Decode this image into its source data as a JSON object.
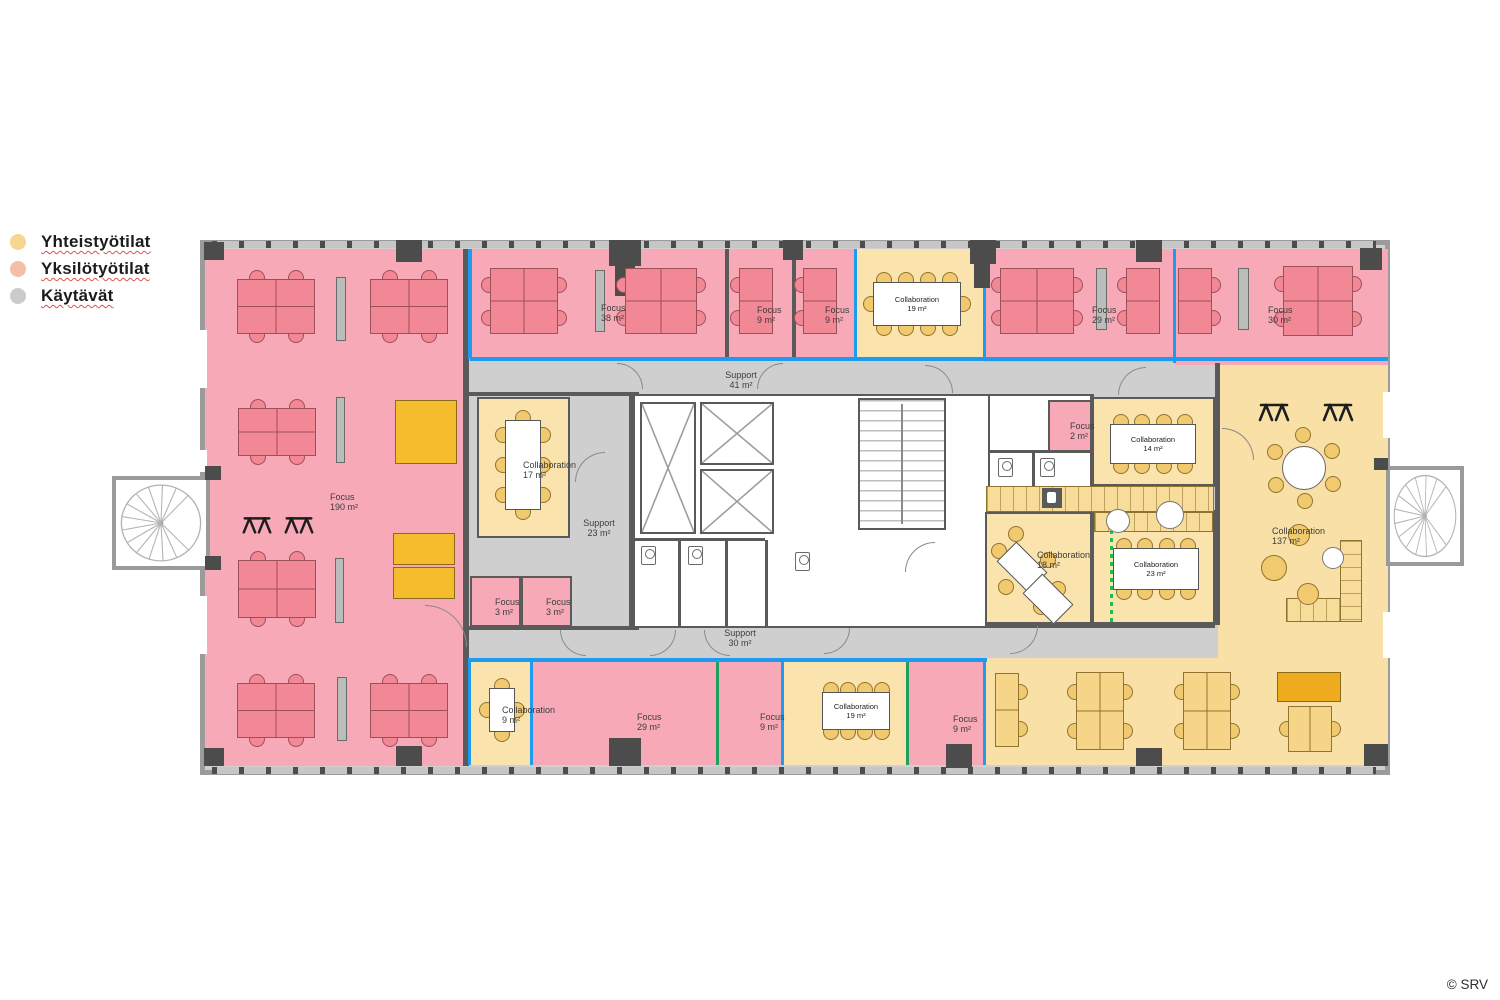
{
  "legend": {
    "items": [
      {
        "id": "yhteistyotilat",
        "label": "Yhteistyötilat",
        "color": "#f6d78f"
      },
      {
        "id": "yksilotyotilat",
        "label": "Yksilötyötilat",
        "color": "#f2bfa9"
      },
      {
        "id": "kaytavat",
        "label": "Käytävät",
        "color": "#cbcbcb"
      }
    ]
  },
  "copyright": "© SRV",
  "palette": {
    "individual_room": "#f7a9b8",
    "collab_room": "#fae3ad",
    "open_collab": "#f9e0a6",
    "corridor": "#cfcfcf",
    "wall": "#5a5a5a",
    "glass_blue": "#1e9bf0",
    "glass_green": "#1fa05c",
    "movable_partition": "#19c24e",
    "desk_pink": "#f28795",
    "desk_yellow": "#f6d488",
    "chair_yellow": "#f1c96f",
    "cabinet_yellow": "#f5bc2e"
  },
  "floorplan": {
    "canvas": {
      "x": 200,
      "y": 240,
      "w": 1190,
      "h": 535
    },
    "rooms": [
      {
        "id": "focus-190",
        "type": "pink",
        "x": 205,
        "y": 249,
        "w": 260,
        "h": 517,
        "label": {
          "name": "Focus",
          "area": "190 m²",
          "x": 330,
          "y": 492
        }
      },
      {
        "id": "focus-38",
        "type": "pink",
        "x": 468,
        "y": 249,
        "w": 259,
        "h": 112,
        "label": {
          "name": "Focus",
          "area": "38 m²",
          "x": 601,
          "y": 303
        }
      },
      {
        "id": "focus-9-a",
        "type": "pink",
        "x": 727,
        "y": 249,
        "w": 67,
        "h": 112,
        "label": {
          "name": "Focus",
          "area": "9 m²",
          "x": 757,
          "y": 305
        }
      },
      {
        "id": "focus-9-b",
        "type": "pink",
        "x": 794,
        "y": 249,
        "w": 62,
        "h": 112,
        "label": {
          "name": "Focus",
          "area": "9 m²",
          "x": 825,
          "y": 305
        }
      },
      {
        "id": "collab-19-top",
        "type": "yellow",
        "x": 856,
        "y": 249,
        "w": 129,
        "h": 112
      },
      {
        "id": "focus-29-top",
        "type": "pink",
        "x": 985,
        "y": 249,
        "w": 190,
        "h": 113,
        "label": {
          "name": "Focus",
          "area": "29 m²",
          "x": 1092,
          "y": 305
        }
      },
      {
        "id": "focus-30",
        "type": "pink",
        "x": 1175,
        "y": 249,
        "w": 213,
        "h": 116,
        "label": {
          "name": "Focus",
          "area": "30 m²",
          "x": 1268,
          "y": 305
        }
      },
      {
        "id": "collab-17",
        "type": "yellow",
        "border": true,
        "x": 477,
        "y": 397,
        "w": 93,
        "h": 141,
        "label": {
          "name": "Collaboration",
          "area": "17 m²",
          "x": 523,
          "y": 460
        }
      },
      {
        "id": "focus-3-a",
        "type": "pink",
        "border": true,
        "x": 470,
        "y": 576,
        "w": 51,
        "h": 51,
        "label": {
          "name": "Focus",
          "area": "3 m²",
          "x": 495,
          "y": 597
        }
      },
      {
        "id": "focus-3-b",
        "type": "pink",
        "border": true,
        "x": 521,
        "y": 576,
        "w": 51,
        "h": 51,
        "label": {
          "name": "Focus",
          "area": "3 m²",
          "x": 546,
          "y": 597
        }
      },
      {
        "id": "core",
        "type": "white",
        "border": true,
        "x": 633,
        "y": 394,
        "w": 357,
        "h": 234
      },
      {
        "id": "wc-right",
        "type": "white",
        "border": true,
        "x": 988,
        "y": 394,
        "w": 104,
        "h": 118
      },
      {
        "id": "focus-2",
        "type": "pink",
        "border": true,
        "x": 1048,
        "y": 400,
        "w": 44,
        "h": 52,
        "label": {
          "name": "Focus",
          "area": "2 m²",
          "x": 1070,
          "y": 421
        }
      },
      {
        "id": "collab-18",
        "type": "yellow",
        "border": true,
        "x": 985,
        "y": 512,
        "w": 107,
        "h": 112,
        "label": {
          "name": "Collaboration",
          "area": "18 m²",
          "x": 1037,
          "y": 550
        }
      },
      {
        "id": "collab-14",
        "type": "yellow",
        "border": true,
        "x": 1092,
        "y": 397,
        "w": 123,
        "h": 89
      },
      {
        "id": "collab-23",
        "type": "yellow",
        "border": true,
        "x": 1092,
        "y": 510,
        "w": 123,
        "h": 114
      },
      {
        "id": "collab-137",
        "type": "open",
        "x": 1218,
        "y": 365,
        "w": 170,
        "h": 400,
        "label": {
          "name": "Collaboration",
          "area": "137 m²",
          "x": 1272,
          "y": 526
        }
      },
      {
        "id": "open-desk-area",
        "type": "open",
        "x": 985,
        "y": 658,
        "w": 403,
        "h": 107
      },
      {
        "id": "collab-9",
        "type": "yellow",
        "x": 470,
        "y": 660,
        "w": 62,
        "h": 105,
        "label": {
          "name": "Collaboration",
          "area": "9 m²",
          "x": 502,
          "y": 705
        }
      },
      {
        "id": "focus-29-bottom",
        "type": "pink",
        "x": 532,
        "y": 660,
        "w": 186,
        "h": 105,
        "label": {
          "name": "Focus",
          "area": "29 m²",
          "x": 637,
          "y": 712
        }
      },
      {
        "id": "focus-9-c",
        "type": "pink",
        "x": 718,
        "y": 660,
        "w": 65,
        "h": 105,
        "label": {
          "name": "Focus",
          "area": "9 m²",
          "x": 760,
          "y": 712
        }
      },
      {
        "id": "collab-19-bottom",
        "type": "yellow",
        "x": 783,
        "y": 660,
        "w": 125,
        "h": 105
      },
      {
        "id": "focus-9-d",
        "type": "pink",
        "x": 908,
        "y": 660,
        "w": 77,
        "h": 105,
        "label": {
          "name": "Focus",
          "area": "9 m²",
          "x": 953,
          "y": 714
        }
      }
    ],
    "support_labels": [
      {
        "name": "Support",
        "area": "41 m²",
        "x": 741,
        "y": 380
      },
      {
        "name": "Support",
        "area": "23 m²",
        "x": 599,
        "y": 528
      },
      {
        "name": "Support",
        "area": "30 m²",
        "x": 740,
        "y": 638
      }
    ],
    "walls": [
      [
        463,
        249,
        6,
        517
      ],
      [
        725,
        249,
        4,
        112
      ],
      [
        792,
        249,
        4,
        112
      ],
      [
        467,
        392,
        172,
        4
      ],
      [
        467,
        626,
        172,
        4
      ],
      [
        629,
        392,
        4,
        238
      ],
      [
        1090,
        394,
        4,
        230
      ],
      [
        1215,
        363,
        5,
        262
      ],
      [
        1092,
        484,
        123,
        3
      ],
      [
        635,
        538,
        130,
        3
      ],
      [
        678,
        541,
        3,
        85
      ],
      [
        725,
        541,
        3,
        85
      ],
      [
        765,
        540,
        3,
        86
      ],
      [
        990,
        450,
        100,
        3
      ],
      [
        1032,
        452,
        3,
        56
      ],
      [
        985,
        624,
        230,
        4
      ]
    ],
    "partitions": {
      "blue": [
        [
          468,
          249,
          4,
          110
        ],
        [
          854,
          249,
          3,
          110
        ],
        [
          983,
          249,
          3,
          112
        ],
        [
          1173,
          249,
          3,
          114
        ],
        [
          470,
          357,
          918,
          4
        ],
        [
          468,
          658,
          519,
          4
        ],
        [
          468,
          662,
          3,
          103
        ],
        [
          530,
          662,
          3,
          103
        ],
        [
          781,
          662,
          3,
          103
        ],
        [
          983,
          662,
          3,
          103
        ]
      ],
      "green": [
        [
          716,
          662,
          3,
          103
        ],
        [
          906,
          662,
          3,
          103
        ]
      ],
      "green_dotted": [
        [
          1110,
          514,
          3,
          108
        ]
      ]
    },
    "columns": [
      [
        204,
        242,
        20,
        18
      ],
      [
        396,
        240,
        26,
        22
      ],
      [
        609,
        240,
        32,
        26
      ],
      [
        615,
        262,
        20,
        34
      ],
      [
        783,
        240,
        20,
        20
      ],
      [
        970,
        240,
        26,
        24
      ],
      [
        974,
        262,
        16,
        26
      ],
      [
        1136,
        240,
        26,
        22
      ],
      [
        1360,
        248,
        22,
        22
      ],
      [
        204,
        748,
        20,
        18
      ],
      [
        396,
        746,
        26,
        20
      ],
      [
        609,
        738,
        32,
        28
      ],
      [
        946,
        744,
        26,
        24
      ],
      [
        1136,
        748,
        26,
        18
      ],
      [
        1364,
        744,
        24,
        22
      ],
      [
        205,
        466,
        16,
        14
      ],
      [
        205,
        556,
        16,
        14
      ],
      [
        1374,
        458,
        14,
        12
      ]
    ],
    "windows": [
      [
        199,
        330,
        8,
        58
      ],
      [
        199,
        450,
        8,
        22
      ],
      [
        199,
        596,
        8,
        58
      ],
      [
        1383,
        392,
        8,
        46
      ],
      [
        1383,
        612,
        8,
        46
      ]
    ],
    "tick_bands": [
      [
        212,
        241,
        1164,
        7
      ],
      [
        212,
        767,
        1164,
        7
      ]
    ],
    "stair_balconies": [
      {
        "id": "spiral-stair-left",
        "x": 112,
        "y": 476,
        "w": 98,
        "h": 94
      },
      {
        "id": "spiral-stair-right",
        "x": 1386,
        "y": 466,
        "w": 78,
        "h": 100
      }
    ],
    "doors": [
      [
        617,
        363,
        26,
        "tr"
      ],
      [
        757,
        363,
        26,
        "tl"
      ],
      [
        925,
        365,
        28,
        "tr"
      ],
      [
        1118,
        367,
        28,
        "tl"
      ],
      [
        575,
        452,
        30,
        "tl"
      ],
      [
        560,
        630,
        26,
        "bl"
      ],
      [
        650,
        630,
        26,
        "br"
      ],
      [
        704,
        630,
        26,
        "bl"
      ],
      [
        824,
        628,
        26,
        "br"
      ],
      [
        1010,
        626,
        28,
        "br"
      ],
      [
        425,
        605,
        42,
        "tr"
      ],
      [
        1222,
        428,
        32,
        "tr"
      ],
      [
        905,
        542,
        30,
        "tl"
      ]
    ],
    "furniture": [
      {
        "k": "deskH",
        "x": 237,
        "y": 279,
        "w": 78,
        "h": 55,
        "n": 2,
        "c": "pink"
      },
      {
        "k": "deskH",
        "x": 370,
        "y": 279,
        "w": 78,
        "h": 55,
        "n": 2,
        "c": "pink"
      },
      {
        "k": "deskH",
        "x": 238,
        "y": 408,
        "w": 78,
        "h": 48,
        "n": 2,
        "c": "pink"
      },
      {
        "k": "deskH",
        "x": 238,
        "y": 560,
        "w": 78,
        "h": 58,
        "n": 2,
        "c": "pink"
      },
      {
        "k": "deskH",
        "x": 237,
        "y": 683,
        "w": 78,
        "h": 55,
        "n": 2,
        "c": "pink"
      },
      {
        "k": "deskH",
        "x": 370,
        "y": 683,
        "w": 78,
        "h": 55,
        "n": 2,
        "c": "pink"
      },
      {
        "k": "panel",
        "x": 336,
        "y": 277,
        "w": 10,
        "h": 64
      },
      {
        "k": "panel",
        "x": 336,
        "y": 397,
        "w": 9,
        "h": 66
      },
      {
        "k": "panel",
        "x": 335,
        "y": 558,
        "w": 9,
        "h": 65
      },
      {
        "k": "panel",
        "x": 337,
        "y": 677,
        "w": 10,
        "h": 64
      },
      {
        "k": "blockY",
        "x": 395,
        "y": 400,
        "w": 62,
        "h": 64
      },
      {
        "k": "blockY",
        "x": 393,
        "y": 533,
        "w": 62,
        "h": 32
      },
      {
        "k": "blockY",
        "x": 393,
        "y": 567,
        "w": 62,
        "h": 32
      },
      {
        "k": "standX",
        "x": 240,
        "y": 510,
        "w": 34,
        "h": 28
      },
      {
        "k": "standX",
        "x": 282,
        "y": 510,
        "w": 34,
        "h": 28
      },
      {
        "k": "deskV",
        "x": 490,
        "y": 268,
        "w": 68,
        "h": 66,
        "n": 2,
        "c": "pink"
      },
      {
        "k": "panel",
        "x": 595,
        "y": 270,
        "w": 10,
        "h": 62
      },
      {
        "k": "deskV",
        "x": 625,
        "y": 268,
        "w": 72,
        "h": 66,
        "n": 2,
        "c": "pink"
      },
      {
        "k": "deskVl",
        "x": 739,
        "y": 268,
        "w": 34,
        "h": 66,
        "n": 2,
        "c": "pink"
      },
      {
        "k": "deskVl",
        "x": 803,
        "y": 268,
        "w": 34,
        "h": 66,
        "n": 2,
        "c": "pink"
      },
      {
        "k": "meetH",
        "x": 873,
        "y": 282,
        "w": 88,
        "h": 44,
        "n": 4,
        "ends": true,
        "label": {
          "name": "Collaboration",
          "area": "19 m²"
        }
      },
      {
        "k": "deskV",
        "x": 1000,
        "y": 268,
        "w": 74,
        "h": 66,
        "n": 2,
        "c": "pink"
      },
      {
        "k": "panel",
        "x": 1096,
        "y": 268,
        "w": 11,
        "h": 62
      },
      {
        "k": "deskVl",
        "x": 1126,
        "y": 268,
        "w": 34,
        "h": 66,
        "n": 2,
        "c": "pink"
      },
      {
        "k": "deskVr",
        "x": 1178,
        "y": 268,
        "w": 34,
        "h": 66,
        "n": 2,
        "c": "pink"
      },
      {
        "k": "panel",
        "x": 1238,
        "y": 268,
        "w": 11,
        "h": 62
      },
      {
        "k": "deskV",
        "x": 1283,
        "y": 266,
        "w": 70,
        "h": 70,
        "n": 2,
        "c": "pink"
      },
      {
        "k": "meetV",
        "x": 505,
        "y": 420,
        "w": 36,
        "h": 90,
        "n": 3,
        "ends": true
      },
      {
        "k": "elev",
        "x": 640,
        "y": 402,
        "w": 56,
        "h": 132
      },
      {
        "k": "elev",
        "x": 700,
        "y": 402,
        "w": 74,
        "h": 63
      },
      {
        "k": "elev",
        "x": 700,
        "y": 469,
        "w": 74,
        "h": 65
      },
      {
        "k": "stair",
        "x": 858,
        "y": 398,
        "w": 88,
        "h": 132
      },
      {
        "k": "wc",
        "x": 641,
        "y": 546
      },
      {
        "k": "wc",
        "x": 688,
        "y": 546
      },
      {
        "k": "wc",
        "x": 795,
        "y": 552
      },
      {
        "k": "wc",
        "x": 998,
        "y": 458
      },
      {
        "k": "wc",
        "x": 1040,
        "y": 458
      },
      {
        "k": "counter",
        "x": 986,
        "y": 486,
        "w": 228,
        "h": 26
      },
      {
        "k": "counter",
        "x": 1094,
        "y": 512,
        "w": 119,
        "h": 20
      },
      {
        "k": "circleW",
        "cx": 1118,
        "cy": 521,
        "r": 12
      },
      {
        "k": "circleW",
        "cx": 1170,
        "cy": 515,
        "r": 14
      },
      {
        "k": "sinkD",
        "x": 1042,
        "y": 488,
        "w": 20,
        "h": 20
      },
      {
        "k": "diamond",
        "x": 1008,
        "y": 545,
        "w": 28,
        "h": 44
      },
      {
        "k": "diamond",
        "x": 1034,
        "y": 577,
        "w": 28,
        "h": 44
      },
      {
        "k": "chairY",
        "cx": 999,
        "cy": 551
      },
      {
        "k": "chairY",
        "cx": 1016,
        "cy": 534
      },
      {
        "k": "chairY",
        "cx": 1048,
        "cy": 560
      },
      {
        "k": "chairY",
        "cx": 1006,
        "cy": 587
      },
      {
        "k": "chairY",
        "cx": 1041,
        "cy": 607
      },
      {
        "k": "chairY",
        "cx": 1058,
        "cy": 589
      },
      {
        "k": "meetH",
        "x": 1110,
        "y": 424,
        "w": 86,
        "h": 40,
        "n": 4,
        "label": {
          "name": "Collaboration",
          "area": "14 m²"
        }
      },
      {
        "k": "meetH",
        "x": 1113,
        "y": 548,
        "w": 86,
        "h": 42,
        "n": 4,
        "label": {
          "name": "Collaboration",
          "area": "23 m²"
        }
      },
      {
        "k": "meetH",
        "x": 822,
        "y": 692,
        "w": 68,
        "h": 38,
        "n": 4,
        "label": {
          "name": "Collaboration",
          "area": "19 m²"
        }
      },
      {
        "k": "meetV",
        "x": 489,
        "y": 688,
        "w": 26,
        "h": 44,
        "n": 1,
        "ends": true
      },
      {
        "k": "standX",
        "x": 1256,
        "y": 396,
        "w": 36,
        "h": 30
      },
      {
        "k": "standX",
        "x": 1320,
        "y": 396,
        "w": 36,
        "h": 30
      },
      {
        "k": "roundT",
        "cx": 1304,
        "cy": 468,
        "r": 22
      },
      {
        "k": "poufY",
        "cx": 1299,
        "cy": 535,
        "r": 11
      },
      {
        "k": "poufY",
        "cx": 1274,
        "cy": 568,
        "r": 13
      },
      {
        "k": "poufY",
        "cx": 1308,
        "cy": 594,
        "r": 11
      },
      {
        "k": "circleW",
        "cx": 1333,
        "cy": 558,
        "r": 11
      },
      {
        "k": "counter",
        "x": 1286,
        "y": 598,
        "w": 76,
        "h": 24
      },
      {
        "k": "counter",
        "x": 1340,
        "y": 540,
        "w": 22,
        "h": 82
      },
      {
        "k": "deskVr",
        "x": 995,
        "y": 673,
        "w": 24,
        "h": 74,
        "n": 2,
        "c": "yellow"
      },
      {
        "k": "deskV",
        "x": 1076,
        "y": 672,
        "w": 48,
        "h": 78,
        "n": 2,
        "c": "yellow"
      },
      {
        "k": "deskV",
        "x": 1183,
        "y": 672,
        "w": 48,
        "h": 78,
        "n": 2,
        "c": "yellow"
      },
      {
        "k": "blockO",
        "x": 1277,
        "y": 672,
        "w": 64,
        "h": 30
      },
      {
        "k": "deskV",
        "x": 1288,
        "y": 706,
        "w": 44,
        "h": 46,
        "n": 1,
        "c": "yellow"
      }
    ]
  }
}
